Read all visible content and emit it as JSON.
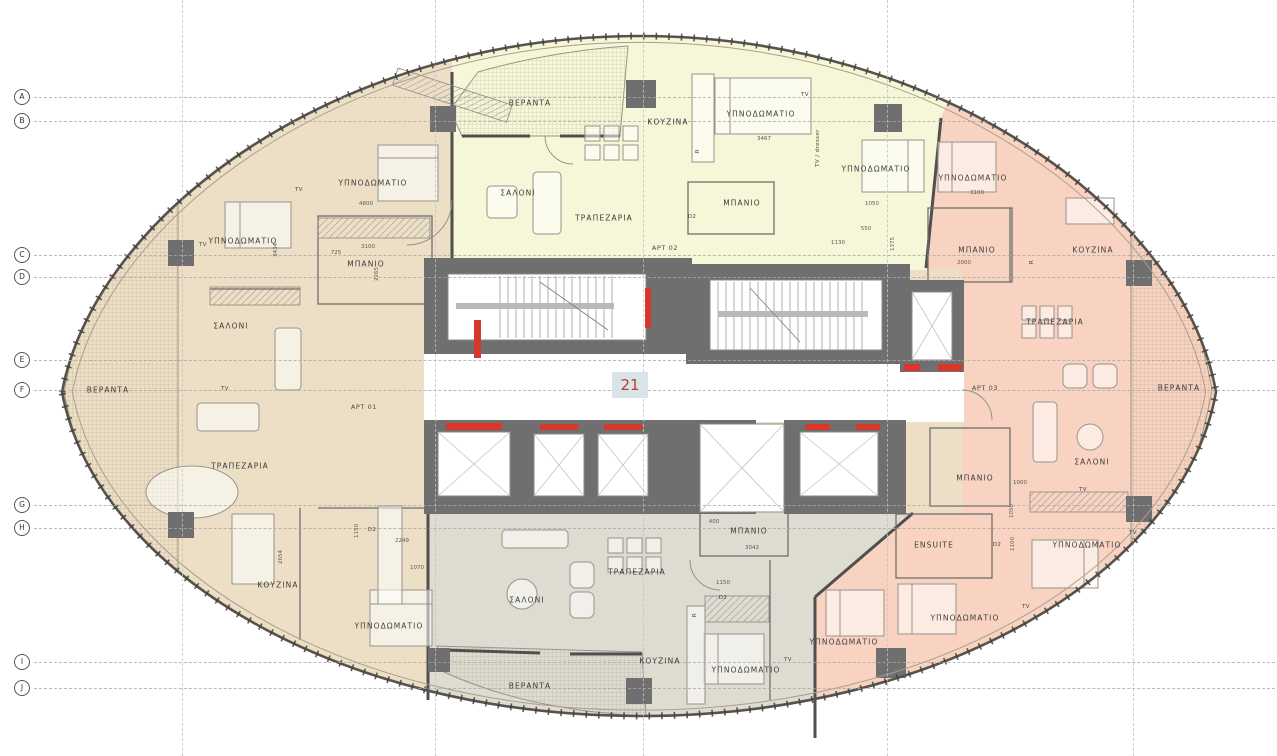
{
  "floor_badge": {
    "number": "21"
  },
  "colors": {
    "apt_west": "#ecdfc6",
    "apt_north": "#f6f6d9",
    "apt_east": "#f8d3c1",
    "apt_south": "#dedbd0",
    "corridor": "#ffffff",
    "core": "#6f6f6f",
    "door_red": "#d9372b",
    "badge_bg": "#d7e5ea",
    "badge_text": "#c0392b",
    "wall": "#4f4f4f"
  },
  "grid": {
    "rows": [
      {
        "letter": "A",
        "y": 97
      },
      {
        "letter": "B",
        "y": 121
      },
      {
        "letter": "C",
        "y": 255
      },
      {
        "letter": "D",
        "y": 277
      },
      {
        "letter": "E",
        "y": 360
      },
      {
        "letter": "F",
        "y": 390
      },
      {
        "letter": "G",
        "y": 505
      },
      {
        "letter": "H",
        "y": 528
      },
      {
        "letter": "I",
        "y": 662
      },
      {
        "letter": "J",
        "y": 688
      }
    ],
    "columns": [
      182,
      435,
      643,
      887,
      1133
    ]
  },
  "annotations": {
    "rooms": [
      {
        "t": "ΥΠΝΟΔΩΜΑΤΙΟ",
        "x": 373,
        "y": 183,
        "apt": "APT 01"
      },
      {
        "t": "ΥΠΝΟΔΩΜΑΤΙΟ",
        "x": 243,
        "y": 241,
        "apt": "APT 01"
      },
      {
        "t": "ΜΠΑΝΙΟ",
        "x": 366,
        "y": 264,
        "apt": "APT 01"
      },
      {
        "t": "ΣΑΛΟΝΙ",
        "x": 231,
        "y": 326,
        "apt": "APT 01"
      },
      {
        "t": "ΒΕΡΑΝΤΑ",
        "x": 108,
        "y": 390,
        "apt": "APT 01"
      },
      {
        "t": "ΤΡΑΠΕΖΑΡΙΑ",
        "x": 240,
        "y": 466,
        "apt": "APT 01"
      },
      {
        "t": "ΚΟΥΖΙΝΑ",
        "x": 278,
        "y": 585,
        "apt": "APT 01"
      },
      {
        "t": "ΥΠΝΟΔΩΜΑΤΙΟ",
        "x": 389,
        "y": 626,
        "apt": "APT 01"
      },
      {
        "t": "ΒΕΡΑΝΤΑ",
        "x": 530,
        "y": 103,
        "apt": "APT 02"
      },
      {
        "t": "ΚΟΥΖΙΝΑ",
        "x": 668,
        "y": 122,
        "apt": "APT 02"
      },
      {
        "t": "ΥΠΝΟΔΩΜΑΤΙΟ",
        "x": 761,
        "y": 114,
        "apt": "APT 02"
      },
      {
        "t": "ΣΑΛΟΝΙ",
        "x": 518,
        "y": 193,
        "apt": "APT 02"
      },
      {
        "t": "ΜΠΑΝΙΟ",
        "x": 742,
        "y": 203,
        "apt": "APT 02"
      },
      {
        "t": "ΤΡΑΠΕΖΑΡΙΑ",
        "x": 604,
        "y": 218,
        "apt": "APT 02"
      },
      {
        "t": "ΥΠΝΟΔΩΜΑΤΙΟ",
        "x": 876,
        "y": 169,
        "apt": "APT 02"
      },
      {
        "t": "ΥΠΝΟΔΩΜΑΤΙΟ",
        "x": 973,
        "y": 178,
        "apt": "APT 03"
      },
      {
        "t": "ΜΠΑΝΙΟ",
        "x": 977,
        "y": 250,
        "apt": "APT 03"
      },
      {
        "t": "ΚΟΥΖΙΝΑ",
        "x": 1093,
        "y": 250,
        "apt": "APT 03"
      },
      {
        "t": "ΤΡΑΠΕΖΑΡΙΑ",
        "x": 1055,
        "y": 322,
        "apt": "APT 03"
      },
      {
        "t": "ΒΕΡΑΝΤΑ",
        "x": 1179,
        "y": 388,
        "apt": "APT 03"
      },
      {
        "t": "ΣΑΛΟΝΙ",
        "x": 1092,
        "y": 462,
        "apt": "APT 03"
      },
      {
        "t": "ΜΠΑΝΙΟ",
        "x": 975,
        "y": 478,
        "apt": "APT 03"
      },
      {
        "t": "ENSUITE",
        "x": 934,
        "y": 545,
        "apt": "APT 03"
      },
      {
        "t": "ΥΠΝΟΔΩΜΑΤΙΟ",
        "x": 1087,
        "y": 545,
        "apt": "APT 03"
      },
      {
        "t": "ΥΠΝΟΔΩΜΑΤΙΟ",
        "x": 965,
        "y": 618,
        "apt": "APT 03"
      },
      {
        "t": "ΜΠΑΝΙΟ",
        "x": 749,
        "y": 531,
        "apt": "APT 04"
      },
      {
        "t": "ΤΡΑΠΕΖΑΡΙΑ",
        "x": 637,
        "y": 572,
        "apt": "APT 04"
      },
      {
        "t": "ΣΑΛΟΝΙ",
        "x": 527,
        "y": 600,
        "apt": "APT 04"
      },
      {
        "t": "ΚΟΥΖΙΝΑ",
        "x": 660,
        "y": 661,
        "apt": "APT 04"
      },
      {
        "t": "ΥΠΝΟΔΩΜΑΤΙΟ",
        "x": 746,
        "y": 670,
        "apt": "APT 04"
      },
      {
        "t": "ΥΠΝΟΔΩΜΑΤΙΟ",
        "x": 844,
        "y": 642,
        "apt": "APT 04"
      },
      {
        "t": "ΒΕΡΑΝΤΑ",
        "x": 530,
        "y": 686,
        "apt": "APT 04"
      }
    ],
    "apartment_tags": [
      {
        "t": "APT 01",
        "x": 364,
        "y": 407
      },
      {
        "t": "APT 02",
        "x": 665,
        "y": 248
      },
      {
        "t": "APT 03",
        "x": 985,
        "y": 388
      }
    ],
    "fixtures": [
      {
        "t": "TV",
        "x": 299,
        "y": 190
      },
      {
        "t": "TV",
        "x": 203,
        "y": 245
      },
      {
        "t": "TV",
        "x": 225,
        "y": 389
      },
      {
        "t": "TV",
        "x": 805,
        "y": 95
      },
      {
        "t": "TV",
        "x": 1083,
        "y": 490
      },
      {
        "t": "TV",
        "x": 1133,
        "y": 533
      },
      {
        "t": "TV",
        "x": 1026,
        "y": 607
      },
      {
        "t": "TV",
        "x": 788,
        "y": 660
      },
      {
        "t": "TV / dresser",
        "x": 818,
        "y": 148,
        "r": -90
      },
      {
        "t": "R",
        "x": 698,
        "y": 151,
        "r": -90
      },
      {
        "t": "R",
        "x": 1032,
        "y": 262,
        "r": -90
      },
      {
        "t": "R",
        "x": 695,
        "y": 615,
        "r": -90
      },
      {
        "t": "D2",
        "x": 692,
        "y": 217
      },
      {
        "t": "D2",
        "x": 723,
        "y": 598
      },
      {
        "t": "D2",
        "x": 372,
        "y": 530
      },
      {
        "t": "D2",
        "x": 997,
        "y": 545
      }
    ],
    "dimensions": [
      {
        "t": "4800",
        "x": 366,
        "y": 204
      },
      {
        "t": "3467",
        "x": 764,
        "y": 139
      },
      {
        "t": "3100",
        "x": 977,
        "y": 193
      },
      {
        "t": "3100",
        "x": 368,
        "y": 247
      },
      {
        "t": "725",
        "x": 336,
        "y": 253
      },
      {
        "t": "2265",
        "x": 377,
        "y": 274,
        "r": -90
      },
      {
        "t": "3434",
        "x": 276,
        "y": 250,
        "r": -90
      },
      {
        "t": "1050",
        "x": 872,
        "y": 204
      },
      {
        "t": "1130",
        "x": 838,
        "y": 243
      },
      {
        "t": "550",
        "x": 866,
        "y": 229
      },
      {
        "t": "2000",
        "x": 964,
        "y": 263
      },
      {
        "t": "1375",
        "x": 893,
        "y": 244,
        "r": -90
      },
      {
        "t": "2654",
        "x": 281,
        "y": 557,
        "r": -90
      },
      {
        "t": "2249",
        "x": 402,
        "y": 541
      },
      {
        "t": "1070",
        "x": 417,
        "y": 568
      },
      {
        "t": "1150",
        "x": 357,
        "y": 531,
        "r": -90
      },
      {
        "t": "3042",
        "x": 752,
        "y": 548
      },
      {
        "t": "1150",
        "x": 723,
        "y": 583
      },
      {
        "t": "400",
        "x": 714,
        "y": 522
      },
      {
        "t": "1000",
        "x": 1020,
        "y": 483
      },
      {
        "t": "1050",
        "x": 1012,
        "y": 511,
        "r": -90
      },
      {
        "t": "1100",
        "x": 1013,
        "y": 544,
        "r": -90
      }
    ]
  }
}
